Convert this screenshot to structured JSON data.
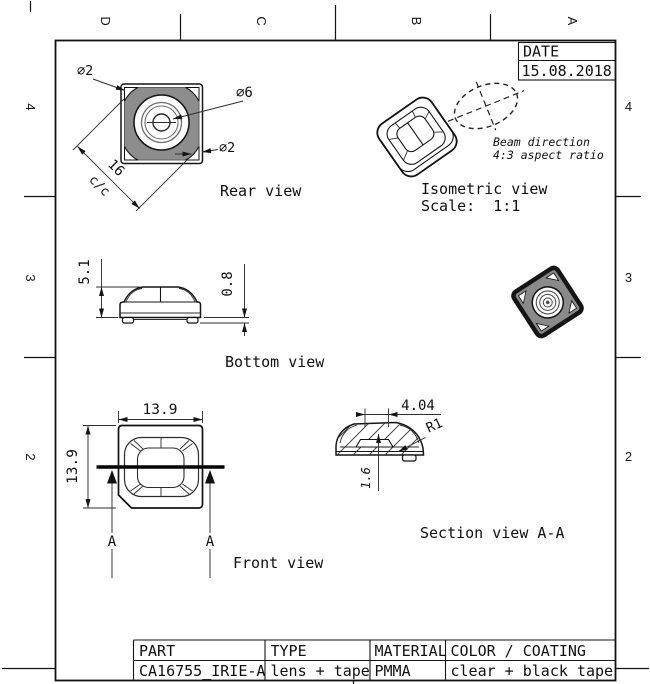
{
  "sheet": {
    "date": {
      "label": "DATE",
      "value": "15.08.2018"
    },
    "zone_columns": [
      "D",
      "C",
      "B",
      "A"
    ],
    "zone_rows": [
      "4",
      "3",
      "2"
    ],
    "title_block": {
      "headers": [
        "PART",
        "TYPE",
        "MATERIAL",
        "COLOR / COATING"
      ],
      "values": [
        "CA16755_IRIE-A",
        "lens + tape",
        "PMMA",
        "clear + black tape"
      ]
    },
    "views": {
      "rear": {
        "label": "Rear view",
        "dia_corner_top": "⌀2",
        "dia_lens": "⌀6",
        "dia_corner_bottom": "⌀2",
        "diagonal_pitch": "16",
        "pitch_note": "c/c"
      },
      "isometric": {
        "label": "Isometric view",
        "scale": "Scale:  1:1",
        "beam_note_1": "Beam direction",
        "beam_note_2": "4:3 aspect ratio"
      },
      "bottom": {
        "label": "Bottom view",
        "height": "5.1",
        "tape_height": "0.8"
      },
      "front": {
        "label": "Front view",
        "width": "13.9",
        "height": "13.9",
        "section_marker": "A"
      },
      "section": {
        "label": "Section view A-A",
        "flat_width": "4.04",
        "radius": "R1",
        "depth": "1.6"
      }
    },
    "colors": {
      "line": "#111111",
      "body_gray": "#8d8d8d",
      "background": "#ffffff"
    }
  }
}
